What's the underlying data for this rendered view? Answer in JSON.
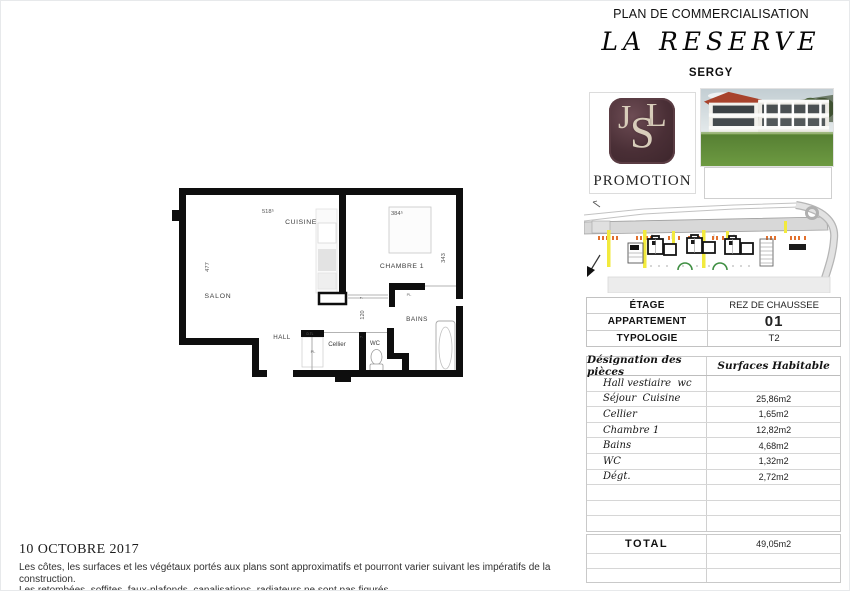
{
  "header": {
    "kicker": "PLAN DE COMMERCIALISATION",
    "title": "LA RESERVE",
    "subtitle": "SERGY"
  },
  "logo": {
    "letter_j": "J",
    "letter_s": "S",
    "letter_l": "L",
    "label": "PROMOTION",
    "bg_color": "#4a2f36",
    "letter_color": "#d8cdba"
  },
  "floorplan": {
    "rooms": {
      "salon": "SALON",
      "cuisine": "CUISINE",
      "chambre": "CHAMBRE 1",
      "hall": "HALL",
      "cellier": "Cellier",
      "wc": "WC",
      "bains": "BAINS"
    },
    "dimensions": {
      "top_left": "518⁵",
      "top_right": "384⁵",
      "left": "477",
      "right": "343",
      "corridor": "120",
      "tick_top": "7",
      "tick_bottom": "7"
    },
    "annotations": {
      "placard_bains": "PL",
      "placard_hall": "PL",
      "dtl": "D.TL"
    }
  },
  "info_table": {
    "rows": [
      {
        "label": "ÉTAGE",
        "value": "REZ DE CHAUSSEE"
      },
      {
        "label": "APPARTEMENT",
        "value": "01"
      },
      {
        "label": "TYPOLOGIE",
        "value": "T2"
      }
    ]
  },
  "surfaces_table": {
    "col_piece": "Désignation des pièces",
    "col_surface": "Surfaces Habitable",
    "rows": [
      {
        "piece": "Hall vestiaire  wc",
        "surface": ""
      },
      {
        "piece": "Séjour  Cuisine",
        "surface": "25,86m2"
      },
      {
        "piece": "Cellier",
        "surface": "1,65m2"
      },
      {
        "piece": "Chambre 1",
        "surface": "12,82m2"
      },
      {
        "piece": "Bains",
        "surface": "4,68m2"
      },
      {
        "piece": "WC",
        "surface": "1,32m2"
      },
      {
        "piece": "Dégt.",
        "surface": "2,72m2"
      },
      {
        "piece": "",
        "surface": ""
      },
      {
        "piece": "",
        "surface": ""
      },
      {
        "piece": "",
        "surface": ""
      }
    ]
  },
  "total_table": {
    "label": "TOTAL",
    "value": "49,05m2"
  },
  "footer": {
    "date": "10 OCTOBRE 2017",
    "line1": "Les côtes, les surfaces et les végétaux portés aux plans sont approximatifs et pourront varier suivant les impératifs de la construction.",
    "line2": "Les retombées, soffites, faux-plafonds, canalisations, radiateurs ne sont pas figurés."
  }
}
